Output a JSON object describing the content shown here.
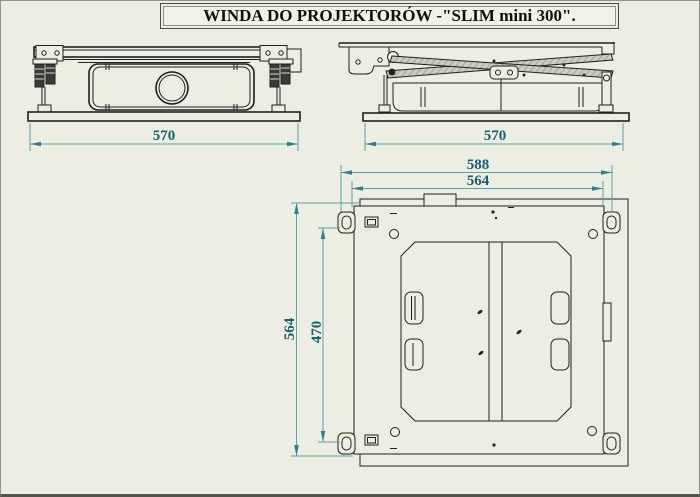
{
  "title": "WINDA DO PROJEKTORÓW -\"SLIM mini 300\".",
  "drawing": {
    "front_view": {
      "width_dim": "570"
    },
    "side_view": {
      "width_dim": "570"
    },
    "plan_view": {
      "outer_width_dim": "588",
      "inner_width_dim": "564",
      "outer_height_dim": "564",
      "inner_height_dim": "470"
    }
  },
  "colors": {
    "background": "#eceee3",
    "drawing_line": "#1f1f1f",
    "dimension_line": "#5aa0a4",
    "dimension_arrow": "#2e8187",
    "dimension_text": "#195f6d"
  }
}
